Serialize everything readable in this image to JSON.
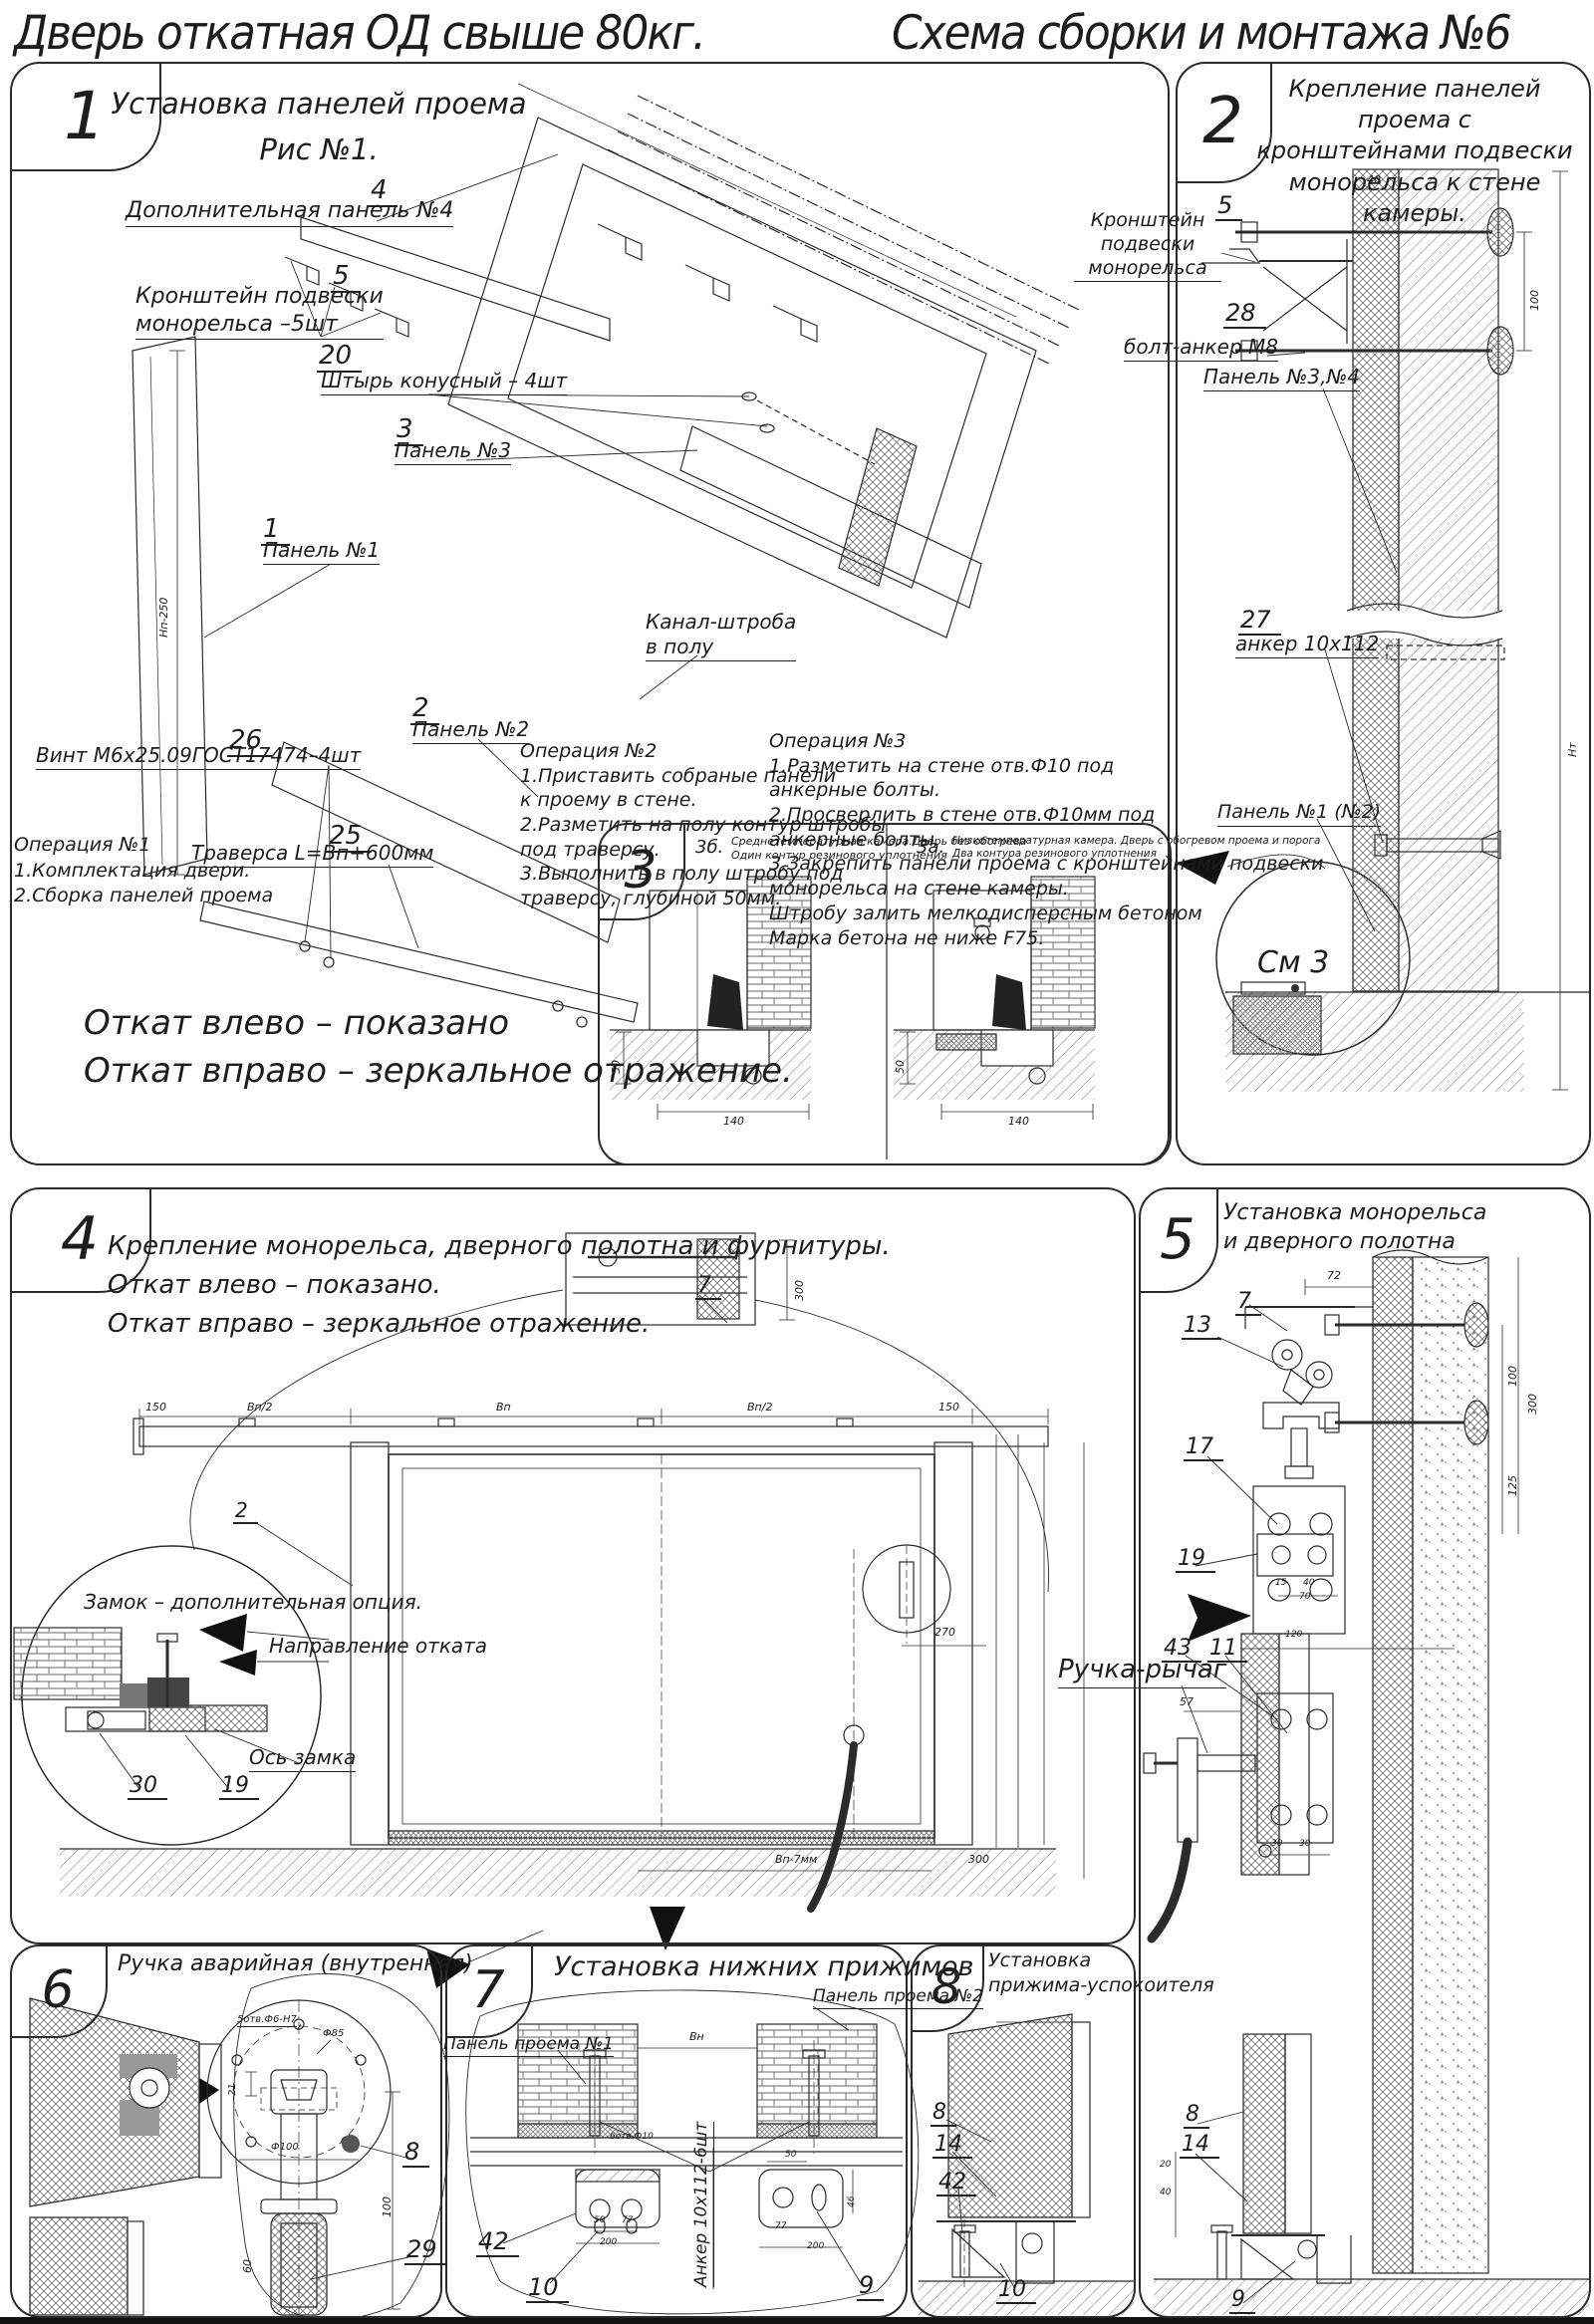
{
  "header": {
    "left": "Дверь откатная ОД свыше 80кг.",
    "right": "Схема сборки и монтажа №6"
  },
  "p1": {
    "num": "1",
    "title": "Установка панелей проема",
    "fig": "Рис №1.",
    "c4n": "4",
    "c4": "Дополнительная панель №4",
    "c5n": "5",
    "c5": "Кронштейн подвески\nмонорельса –5шт",
    "c20n": "20",
    "c20": "Штырь конусный – 4шт",
    "c3n": "3",
    "c3": "Панель №3",
    "c1n": "1",
    "c1": "Панель №1",
    "c2n": "2",
    "c2": "Панель №2",
    "c26n": "26",
    "c26": "Винт М6х25.09ГОСТ17474–4шт",
    "c25n": "25",
    "c25": "Траверса  L=Вп+600мм",
    "kanal": "Канал-штроба\nв полу",
    "op1": "Операция №1\n1.Комплектация двери.\n2.Сборка панелей проема",
    "op2": "Операция №2\n1.Приставить собраные панели\nк проему в стене.\n2.Разметить на полу контур штробы\nпод траверсу.\n3.Выполнить в полу штробу под\nтраверсу, глубиной 50мм.",
    "op3": "Операция №3\n1.Разметить на стене отв.Ф10 под\nанкерные болты.\n2.Просверлить в стене отв.Ф10мм  под\nанкерные болты.\n3.Закрепить панели проема с кронштейнами подвески\nмонорельса на стене камеры.\nШтробу залить мелкодисперсным бетоном\nМарка бетона не ниже  F75.",
    "note1": "Откат влево – показано",
    "note2": "Откат вправо – зеркальное отражение.",
    "dimh": "Нп-250"
  },
  "p2": {
    "num": "2",
    "title": "Крепление панелей проема с\nкронштейнами  подвески\nмонорельса к стене камеры.",
    "c5n": "5",
    "c5": "Кронштейн\nподвески монорельса",
    "c28n": "28",
    "c28": "болт-анкер М8",
    "p34": "Панель №3,№4",
    "c27n": "27",
    "c27": "анкер 10х112",
    "p12": "Панель №1 (№2)",
    "see3": "См 3",
    "d40": "40",
    "d100": "100",
    "dnt": "Нт"
  },
  "p3": {
    "num": "3",
    "lb": "3б.",
    "nb": "Среднетемпературная камера.Дверь без обогрева\nОдин контур резинового уплотнения",
    "la": "3а.",
    "na": "Низкотемпературная камера. Дверь с обогревом проема и порога\nДва контура резинового уплотнения",
    "d50": "50",
    "d140": "140"
  },
  "p4": {
    "num": "4",
    "title": "Крепление монорельса, дверного полотна и фурнитуры.\nОткат влево – показано.\nОткат вправо – зеркальное отражение.",
    "c7": "7",
    "c2": "2",
    "lock": "Замок – дополнительная опция.",
    "dir": "Направление отката",
    "axis": "Ось замка",
    "n30": "30",
    "n19": "19",
    "d150": "150",
    "dvp2": "Вп/2",
    "dvp": "Вп",
    "d270": "270",
    "dvp7": "Вп-7мм",
    "d300": "300"
  },
  "p5": {
    "num": "5",
    "title": "Установка монорельса\nи дверного полотна",
    "c7": "7",
    "c13": "13",
    "c17": "17",
    "c19": "19",
    "c43": "43",
    "c11": "11",
    "handle": "Ручка-рычаг",
    "d72": "72",
    "d100": "100",
    "d300": "300",
    "d125": "125",
    "d15": "15",
    "d40": "40",
    "d70": "70",
    "d120": "120",
    "d57": "57",
    "d30": "30",
    "c8": "8",
    "c14": "14",
    "c9": "9",
    "d20": "20"
  },
  "p6": {
    "num": "6",
    "title": "Ручка аварийная (внутренняя)",
    "holes": "5отв.Ф6-Н7",
    "d85": "Ф85",
    "d21": "21",
    "d100f": "Ф100",
    "c8": "8",
    "c29": "29",
    "d60": "60",
    "dv100": "100"
  },
  "p7": {
    "num": "7",
    "title": "Установка  нижних  прижимов",
    "pp2": "Панель проема №2",
    "pp1": "Панель проема №1",
    "anchor": "Анкер  10х112-6шт",
    "c42": "42",
    "c10": "10",
    "c9": "9",
    "dvn": "Вн",
    "holes": "6отв.Ф10",
    "d50": "50",
    "d77": "77",
    "d200": "200",
    "d46": "46"
  },
  "p8": {
    "num": "8",
    "title": "Установка\nприжима-успокоителя",
    "c8": "8",
    "c14": "14",
    "c42": "42",
    "c10": "10"
  }
}
